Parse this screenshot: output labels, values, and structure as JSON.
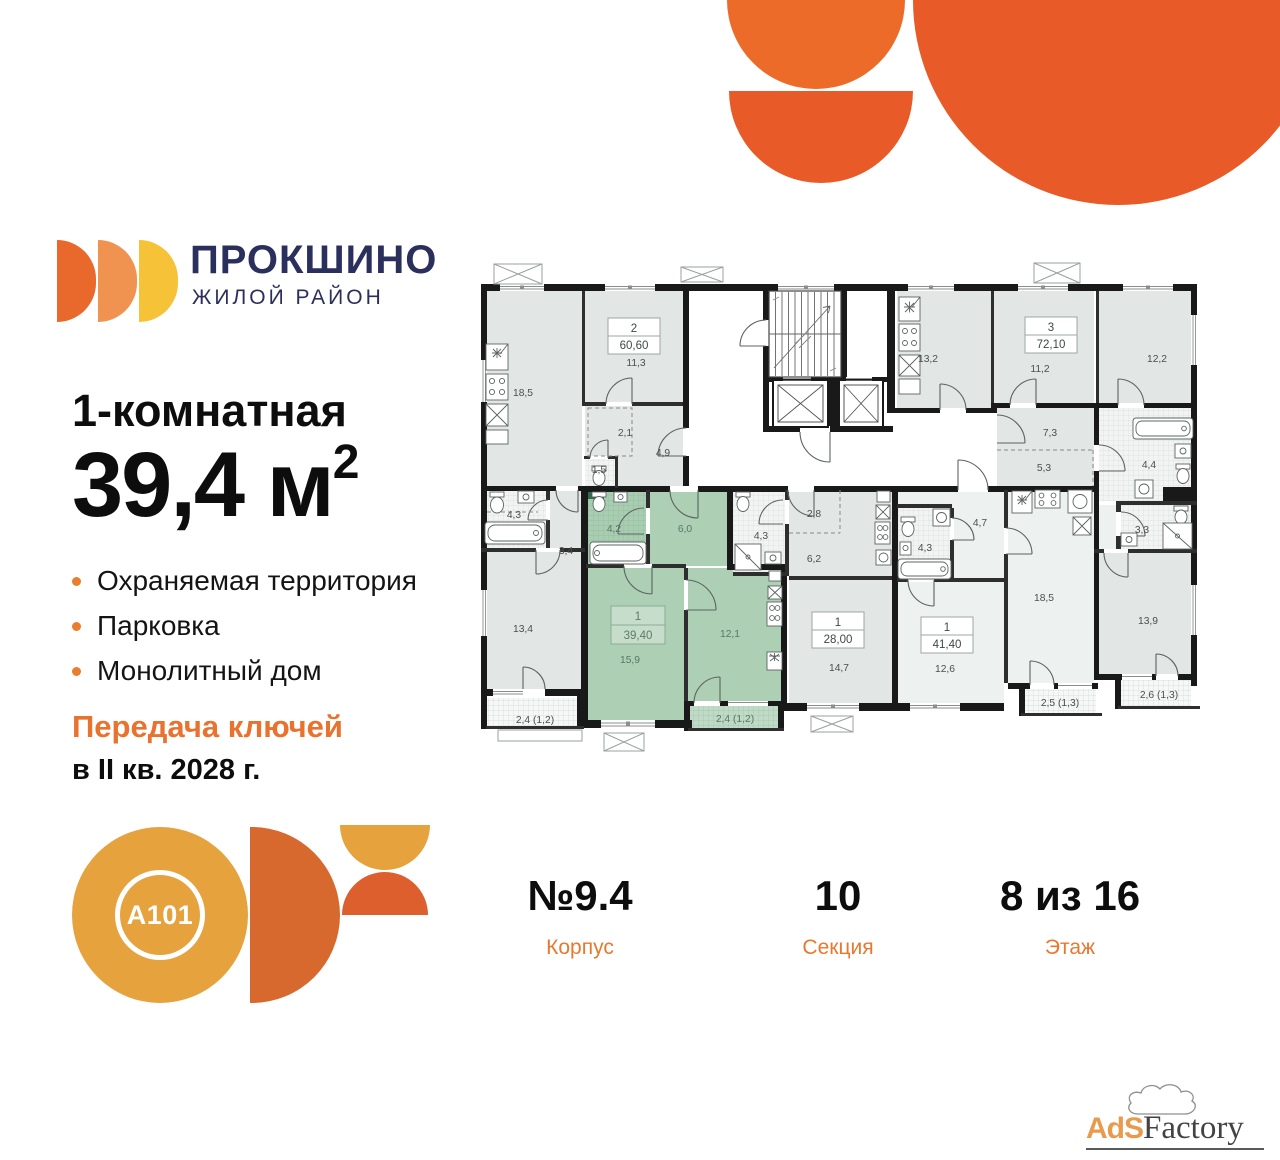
{
  "brand": {
    "name": "ПРОКШИНО",
    "tagline": "ЖИЛОЙ РАЙОН"
  },
  "listing": {
    "title": "1-комнатная",
    "area_value": "39,4",
    "area_unit": "м",
    "area_sup": "2",
    "features": [
      "Охраняемая территория",
      "Парковка",
      "Монолитный дом"
    ],
    "handover_accent": "Передача ключей",
    "handover_date": "в II кв. 2028 г."
  },
  "details": [
    {
      "value": "№9.4",
      "label": "Корпус"
    },
    {
      "value": "10",
      "label": "Секция"
    },
    {
      "value": "8 из 16",
      "label": "Этаж"
    }
  ],
  "developer": {
    "logo_text": "A101"
  },
  "watermark": {
    "part1": "AdS",
    "part2": "Factory"
  },
  "plan": {
    "apartments": [
      {
        "number": "2",
        "area": "60,60"
      },
      {
        "number": "3",
        "area": "72,10"
      },
      {
        "number": "1",
        "area": "39,40",
        "highlighted": true
      },
      {
        "number": "1",
        "area": "28,00"
      },
      {
        "number": "1",
        "area": "41,40"
      }
    ],
    "rooms": [
      "18,5",
      "11,3",
      "2,1",
      "4,9",
      "1,5",
      "4,3",
      "3,4",
      "13,4",
      "2,4 (1,2)",
      "4,2",
      "6,0",
      "15,9",
      "12,1",
      "2,4 (1,2)",
      "4,3",
      "2,8",
      "6,2",
      "14,7",
      "13,2",
      "11,2",
      "12,2",
      "7,3",
      "5,3",
      "4,4",
      "3,3",
      "13,9",
      "2,5 (1,3)",
      "2,6 (1,3)",
      "4,7",
      "4,3",
      "12,6",
      "18,5"
    ],
    "colors": {
      "highlight": "#ADCFB4",
      "accent": "#E8722E",
      "navy": "#2B2F5C"
    }
  }
}
